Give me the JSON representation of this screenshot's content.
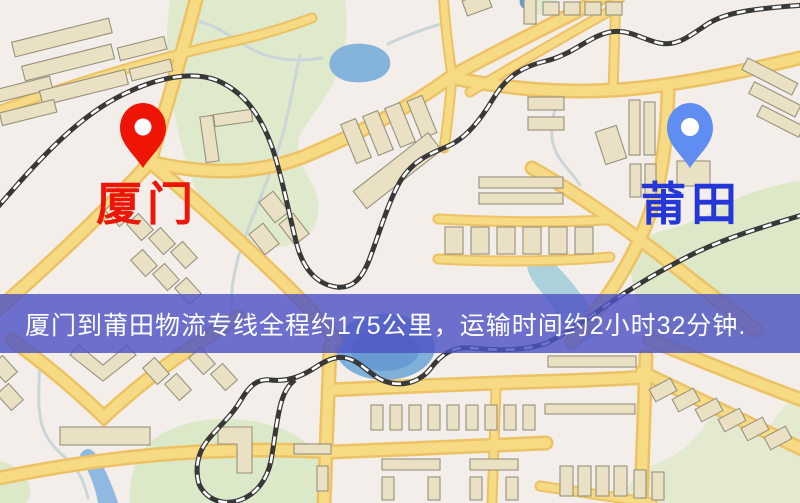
{
  "banner": {
    "text": "厦门到莆田物流专线全程约175公里，运输时间约2小时32分钟.",
    "bg_color": "#4e53c4",
    "text_color": "#ffffff"
  },
  "markers": [
    {
      "id": "xiamen",
      "label": "厦门",
      "pin_color": "#ee1506",
      "label_color": "#ec150a"
    },
    {
      "id": "putian",
      "label": "莆田",
      "pin_color": "#5f8df2",
      "label_color": "#2537d6"
    }
  ],
  "palette": {
    "land": "#f3eee9",
    "road_fill": "#f7da84",
    "road_casing": "#ecc264",
    "park": "#dfe9cb",
    "water": "#84b3dc",
    "building": "#eae1c4",
    "railway": "#383838"
  }
}
